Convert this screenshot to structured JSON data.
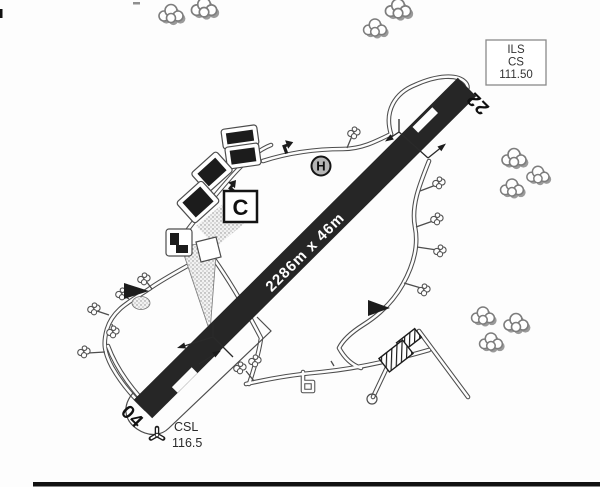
{
  "runway": {
    "dimensions": "2286m x 46m",
    "designator_ne": "22",
    "designator_sw": "04"
  },
  "ils_box": {
    "line1": "ILS",
    "line2": "CS",
    "line3": "111.50"
  },
  "vor": {
    "ident": "CSL",
    "frequency": "116.5"
  },
  "signs": {
    "holding_point": "C",
    "helipad": "H"
  },
  "colors": {
    "runway_fill": "#262626",
    "taxiway_outline": "#4d4d4d",
    "tree_gray": "#8f8f8f",
    "paper": "#fdfdfd",
    "ink": "#1c1c1c"
  }
}
